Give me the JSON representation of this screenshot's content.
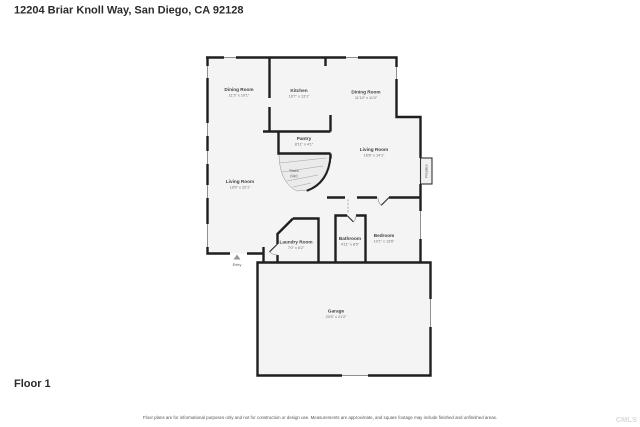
{
  "page": {
    "title": "12204 Briar Knoll Way, San Diego, CA 92128",
    "floor_label": "Floor 1",
    "disclaimer": "Floor plans are for informational purposes only and not for construction or design use. Measurements are approximate, and square footage may include finished and unfinished areas.",
    "watermark": "CMLS"
  },
  "rooms": [
    {
      "name": "Dining Room",
      "dims": "11'3\" x 10'1\""
    },
    {
      "name": "Kitchen",
      "dims": "16'7\" x 13'1\""
    },
    {
      "name": "Dining Room",
      "dims": "11'10\" x 11'0\""
    },
    {
      "name": "Living Room",
      "dims": "16'8\" x 14'1\""
    },
    {
      "name": "Pantry",
      "dims": "8'11\" x 4'1\""
    },
    {
      "name": "Living Room",
      "dims": "19'9\" x 22'1\""
    },
    {
      "name": "Laundry Room",
      "dims": "7'0\" x 6'2\""
    },
    {
      "name": "Bathroom",
      "dims": "4'11\" x 8'5\""
    },
    {
      "name": "Bedroom",
      "dims": "10'1\" x 13'6\""
    },
    {
      "name": "Garage",
      "dims": "20'5\" x 21'2\""
    }
  ],
  "markers": {
    "stairs_line1": "Stairs",
    "stairs_line2": "(Up)",
    "fireplace": "Fireplace",
    "entry": "Entry"
  },
  "colors": {
    "wall": "#1f1f1f",
    "floor": "#f4f4f4",
    "stairs_fill": "#ebebeb",
    "fireplace_fill": "#f0f0f0"
  }
}
